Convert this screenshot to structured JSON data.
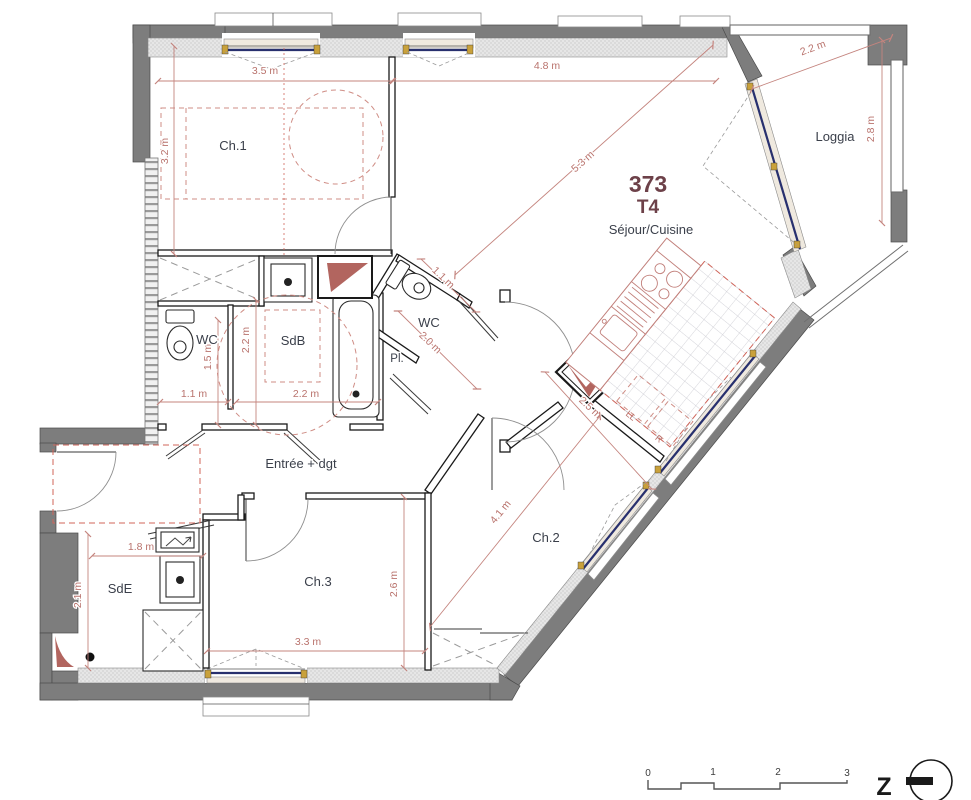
{
  "plan": {
    "unit": {
      "number": "373",
      "type": "T4"
    },
    "rooms": {
      "ch1": "Ch.1",
      "sejour": "Séjour/Cuisine",
      "loggia": "Loggia",
      "wc1": "WC",
      "sdb": "SdB",
      "wc2": "WC",
      "placard": "Pl.",
      "entree": "Entrée + dgt",
      "sde": "SdE",
      "ch3": "Ch.3",
      "ch2": "Ch.2"
    },
    "appliances": {
      "washing_machine": "LL",
      "fridge": "R"
    },
    "dims": {
      "ch1_width": "3.5 m",
      "ch1_height": "3.2 m",
      "sejour_width": "4.8 m",
      "sejour_diagonal": "5.3 m",
      "loggia_width": "2.2 m",
      "loggia_height": "2.8 m",
      "sdb_height": "2.2 m",
      "wc1_height": "1.5 m",
      "wc1_width": "1.1 m",
      "sdb_width": "2.2 m",
      "wc2_width": "1.1 m",
      "wc2_length": "2.0 m",
      "kitchen_width": "2.5 m",
      "sde_width": "1.8 m",
      "sde_height": "2.1 m",
      "ch3_width": "3.3 m",
      "ch3_height": "2.6 m",
      "ch2_length": "4.1 m"
    },
    "scale_bar": {
      "ticks": [
        "0",
        "1",
        "2",
        "3"
      ]
    },
    "north": {
      "label": "Z"
    },
    "colors": {
      "wall": "#7d7d7d",
      "insulation": "#e6e6e6",
      "dimension": "#c4847e",
      "label": "#3a3f4a",
      "unit_number": "#6d4149",
      "glazing": "#28306e",
      "frame_accent": "#c9a13b",
      "zone_dashed": "#d0655a",
      "duct_marker": "#b2655f"
    }
  }
}
